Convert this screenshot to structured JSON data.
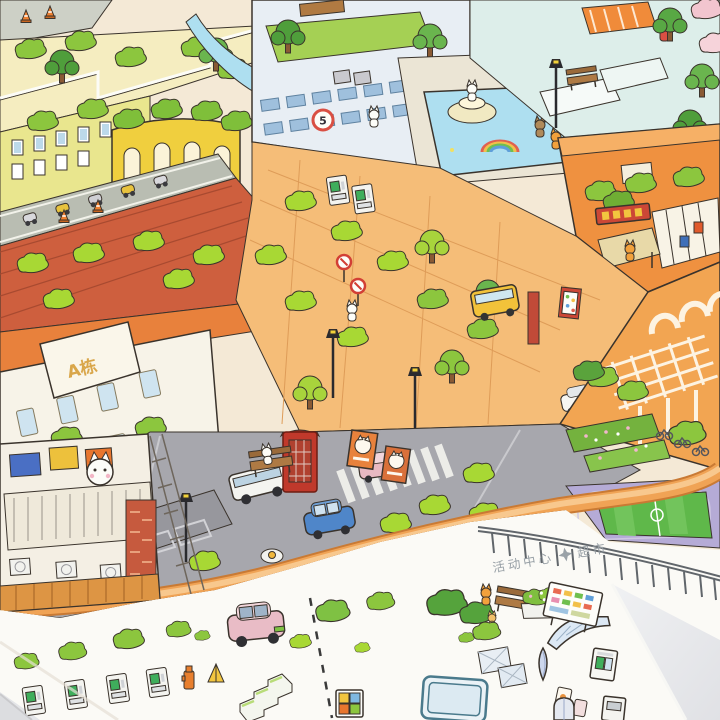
{
  "scene": {
    "description": "Photograph of a hand-drawn isometric cartoon city map poster; the lower margin of the sheet is a sticker area with small object stickers on white paper, lying on a light gray table.",
    "landmarks": [
      "rooftop-garden-apartments",
      "round-yellow-arena",
      "modern-glass-building",
      "fountain-plaza-with-rainbow-pool",
      "orange-post-building-with-red-sign",
      "terracotta-roof-district",
      "building-a-facade",
      "market-street",
      "arched-arcade-building",
      "red-telephone-booth",
      "zebra-crosswalk",
      "blue-hatchback",
      "white-van",
      "sports-field-with-purple-track",
      "elevated-boardwalk-pier",
      "sticker-margin"
    ]
  },
  "labels": {
    "building_a": "A栋",
    "speed_limit_sign": "5",
    "district_caption_left": "活动中心",
    "district_caption_right": "超市"
  },
  "palette": {
    "table": "#e4e5e8",
    "paper": "#fbfaf6",
    "city_base": "#f4e9d6",
    "road_gray": "#a7a7ad",
    "road_orange": "#f0a355",
    "water": "#aedff0",
    "track_purple": "#b5abd6",
    "field_green": "#5fb84a",
    "foliage": "#8cc63e",
    "foliage_light": "#a8d834",
    "foliage_dark": "#55a33c",
    "terracotta": "#ce5f3e",
    "building_orange": "#ef9140",
    "building_cream": "#f7f3e8",
    "building_blue": "#e8eef4",
    "window_blue": "#bcd9ea",
    "booth_red": "#c0392b",
    "sign_red": "#cc4736",
    "car_blue": "#4f86c9",
    "car_pink": "#e9bcc6",
    "bench_brown": "#ae7a44",
    "ink": "#3a332c",
    "caption_gray": "#98a0a6"
  }
}
